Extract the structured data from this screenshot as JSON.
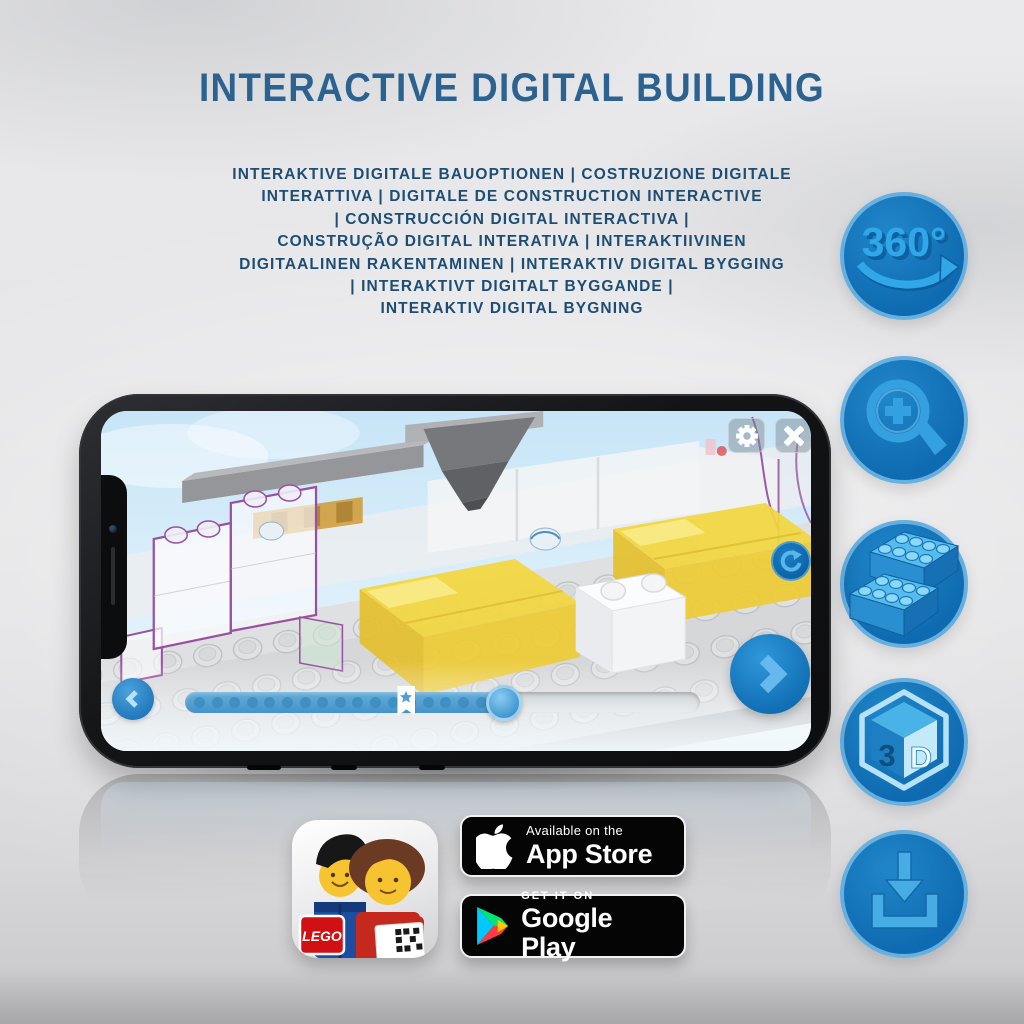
{
  "title": "INTERACTIVE DIGITAL BUILDING",
  "subtitle_lines": [
    "INTERAKTIVE DIGITALE BAUOPTIONEN | COSTRUZIONE DIGITALE",
    "INTERATTIVA | DIGITALE DE CONSTRUCTION INTERACTIVE",
    "| CONSTRUCCIÓN DIGITAL INTERACTIVA |",
    "CONSTRUÇÃO DIGITAL INTERATIVA | INTERAKTIIVINEN",
    "DIGITAALINEN RAKENTAMINEN | INTERAKTIV DIGITAL BYGGING",
    "| INTERAKTIVT DIGITALT BYGGANDE |",
    "INTERAKTIV DIGITAL BYGNING"
  ],
  "feature_icons": [
    {
      "name": "rotate-360-icon",
      "label": "360°"
    },
    {
      "name": "zoom-in-icon"
    },
    {
      "name": "brick-options-icon"
    },
    {
      "name": "3d-view-icon",
      "label_three": "3",
      "label_d": "D"
    },
    {
      "name": "download-icon"
    }
  ],
  "phone": {
    "progress": {
      "dot_count": 18,
      "thumb_percent": 62,
      "bookmark_percent": 43
    }
  },
  "badges": {
    "lego_app": {
      "logo_text": "LEGO"
    },
    "app_store": {
      "line1": "Available on the",
      "line2": "App Store"
    },
    "google_play": {
      "line1": "GET IT ON",
      "line2": "Google Play"
    }
  },
  "colors": {
    "title": "#2c6290",
    "subtitle": "#1d4d73",
    "icon-circle": "#0f6bb1",
    "icon-glyph": "#34a0e0",
    "screen-bg": "#d4ebf8",
    "accent-blue": "#2e8fd0",
    "bed-yellow": "#f2d640",
    "badge-black": "#050505"
  }
}
